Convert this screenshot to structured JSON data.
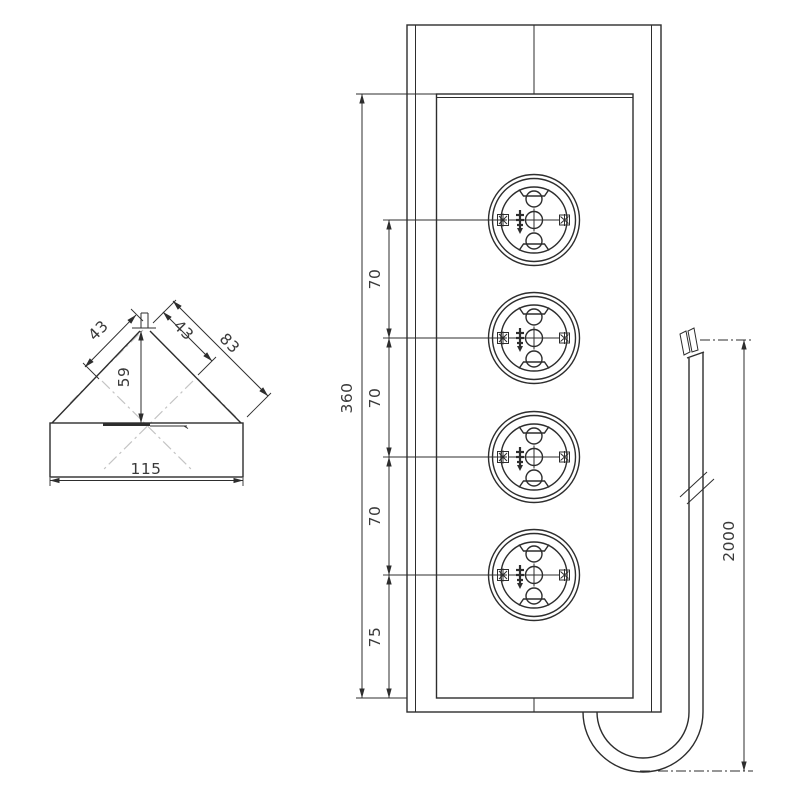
{
  "drawing": {
    "side_view": {
      "dim_width": "115",
      "dim_height": "59",
      "dim_edge_left": "43",
      "dim_edge_right_inner": "43",
      "dim_edge_right_outer": "83"
    },
    "front_view": {
      "dim_total_height": "360",
      "dim_spacing_1": "70",
      "dim_spacing_2": "70",
      "dim_spacing_3": "70",
      "dim_bottom_offset": "75",
      "socket_count": 4
    },
    "cable": {
      "dim_length": "2000"
    },
    "colors": {
      "line": "#2d2d2d",
      "centerline": "#c4c4c4",
      "background": "#ffffff"
    }
  }
}
